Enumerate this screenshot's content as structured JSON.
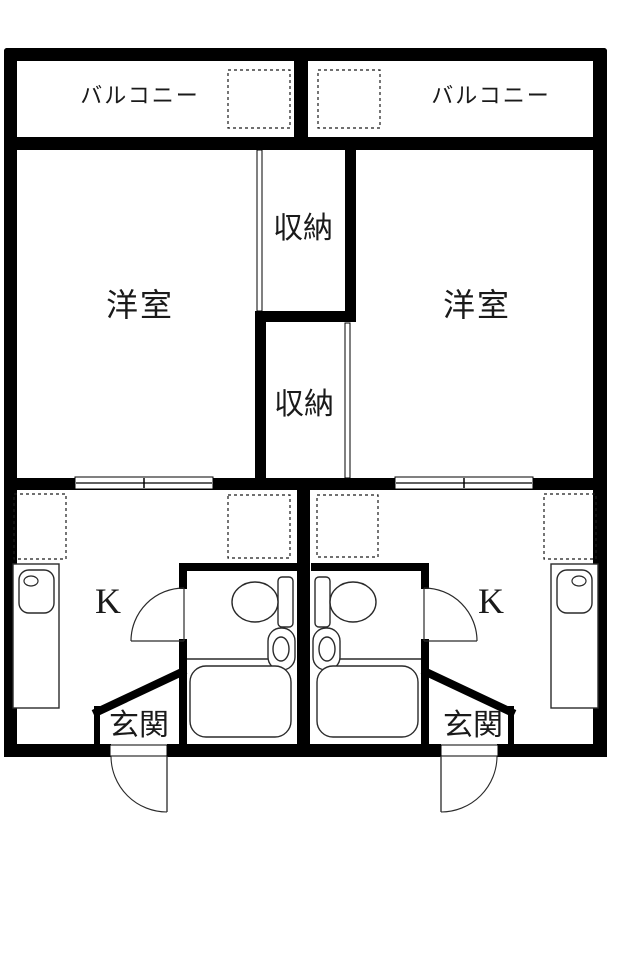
{
  "floorplan": {
    "title": "apartment-floor-plan-two-units",
    "balcony_left_label": "バルコニー",
    "balcony_right_label": "バルコニー",
    "room_left_label": "洋室",
    "room_right_label": "洋室",
    "closet_upper_label": "収納",
    "closet_lower_label": "収納",
    "kitchen_left_label": "K",
    "kitchen_right_label": "K",
    "entrance_left_label": "玄関",
    "entrance_right_label": "玄関",
    "fixtures": {
      "toilet": "toilet-icon",
      "bathtub": "bathtub-icon",
      "wash_basin": "wash-basin-icon",
      "kitchen_sink": "kitchen-sink-icon",
      "door_swing": "door-swing-arc",
      "sliding_door": "sliding-door"
    },
    "colors": {
      "wall": "#000000",
      "background": "#ffffff",
      "line": "#1a1a1a"
    }
  }
}
